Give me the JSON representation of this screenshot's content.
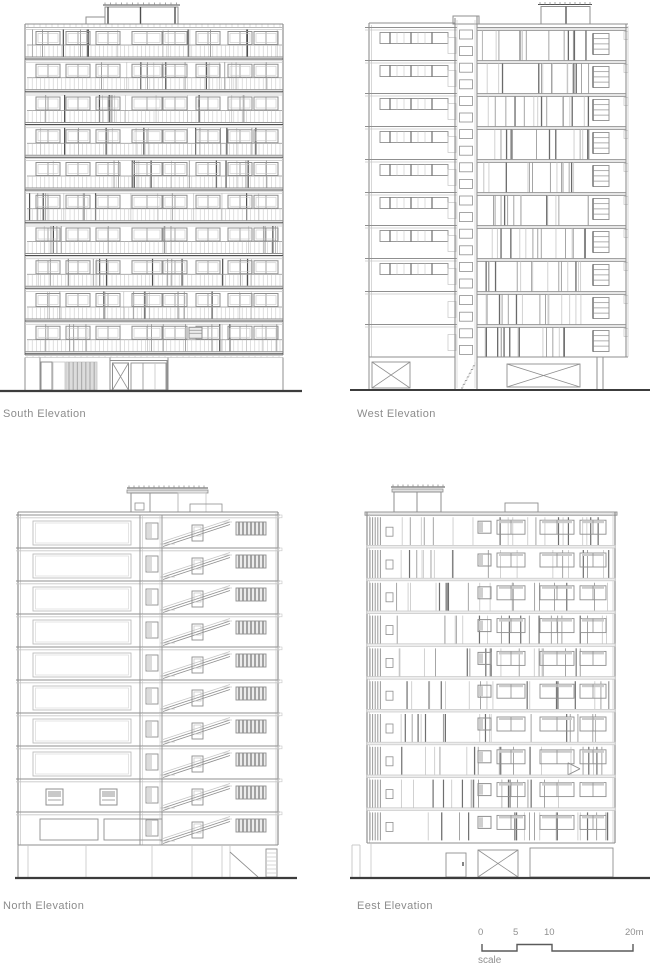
{
  "sheet": {
    "background": "#ffffff"
  },
  "panels": [
    {
      "id": "south",
      "label": "South Elevation",
      "floors": 10
    },
    {
      "id": "west",
      "label": "West Elevation",
      "floors": 10
    },
    {
      "id": "north",
      "label": "North Elevation",
      "floors": 10
    },
    {
      "id": "east",
      "label": "Eest Elevation",
      "floors": 10
    }
  ],
  "scale_bar": {
    "ticks": [
      "0",
      "5",
      "10",
      "20m"
    ],
    "caption": "scale"
  },
  "colors": {
    "line_light": "#c6c6c6",
    "line_mid": "#8f8f8f",
    "line_dark": "#4f4f4f",
    "shade": "#d8d8d8",
    "label_text": "#8c8c8c",
    "ground": "#3c3c3c",
    "scale_bar": "#5a5a5a"
  }
}
